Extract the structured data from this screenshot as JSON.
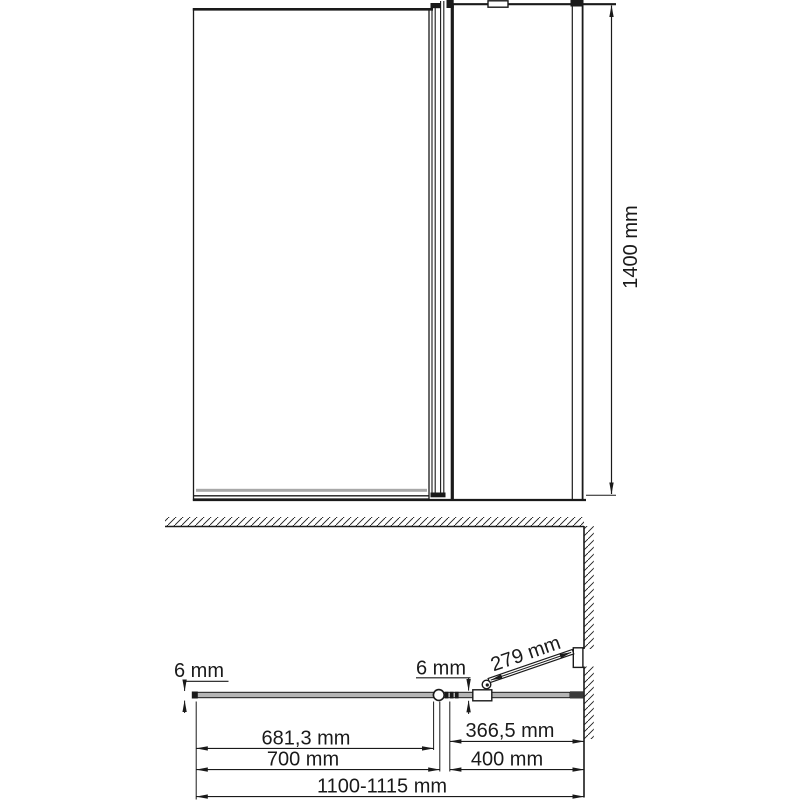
{
  "drawing": {
    "kind": "bath-screen-dimension-drawing",
    "background": "#ffffff",
    "line_color": "#1a1a1a",
    "glass_color": "#b5b5b5"
  },
  "labels": {
    "height": "1400 mm",
    "glass_thickness_fixed": "6 mm",
    "glass_thickness_door": "6 mm",
    "door_open_length": "279 mm",
    "fixed_glass_width": "681,3 mm",
    "fixed_section_width": "700 mm",
    "door_glass_width": "366,5 mm",
    "door_section_width": "400 mm",
    "total_width": "1100-1115 mm"
  }
}
